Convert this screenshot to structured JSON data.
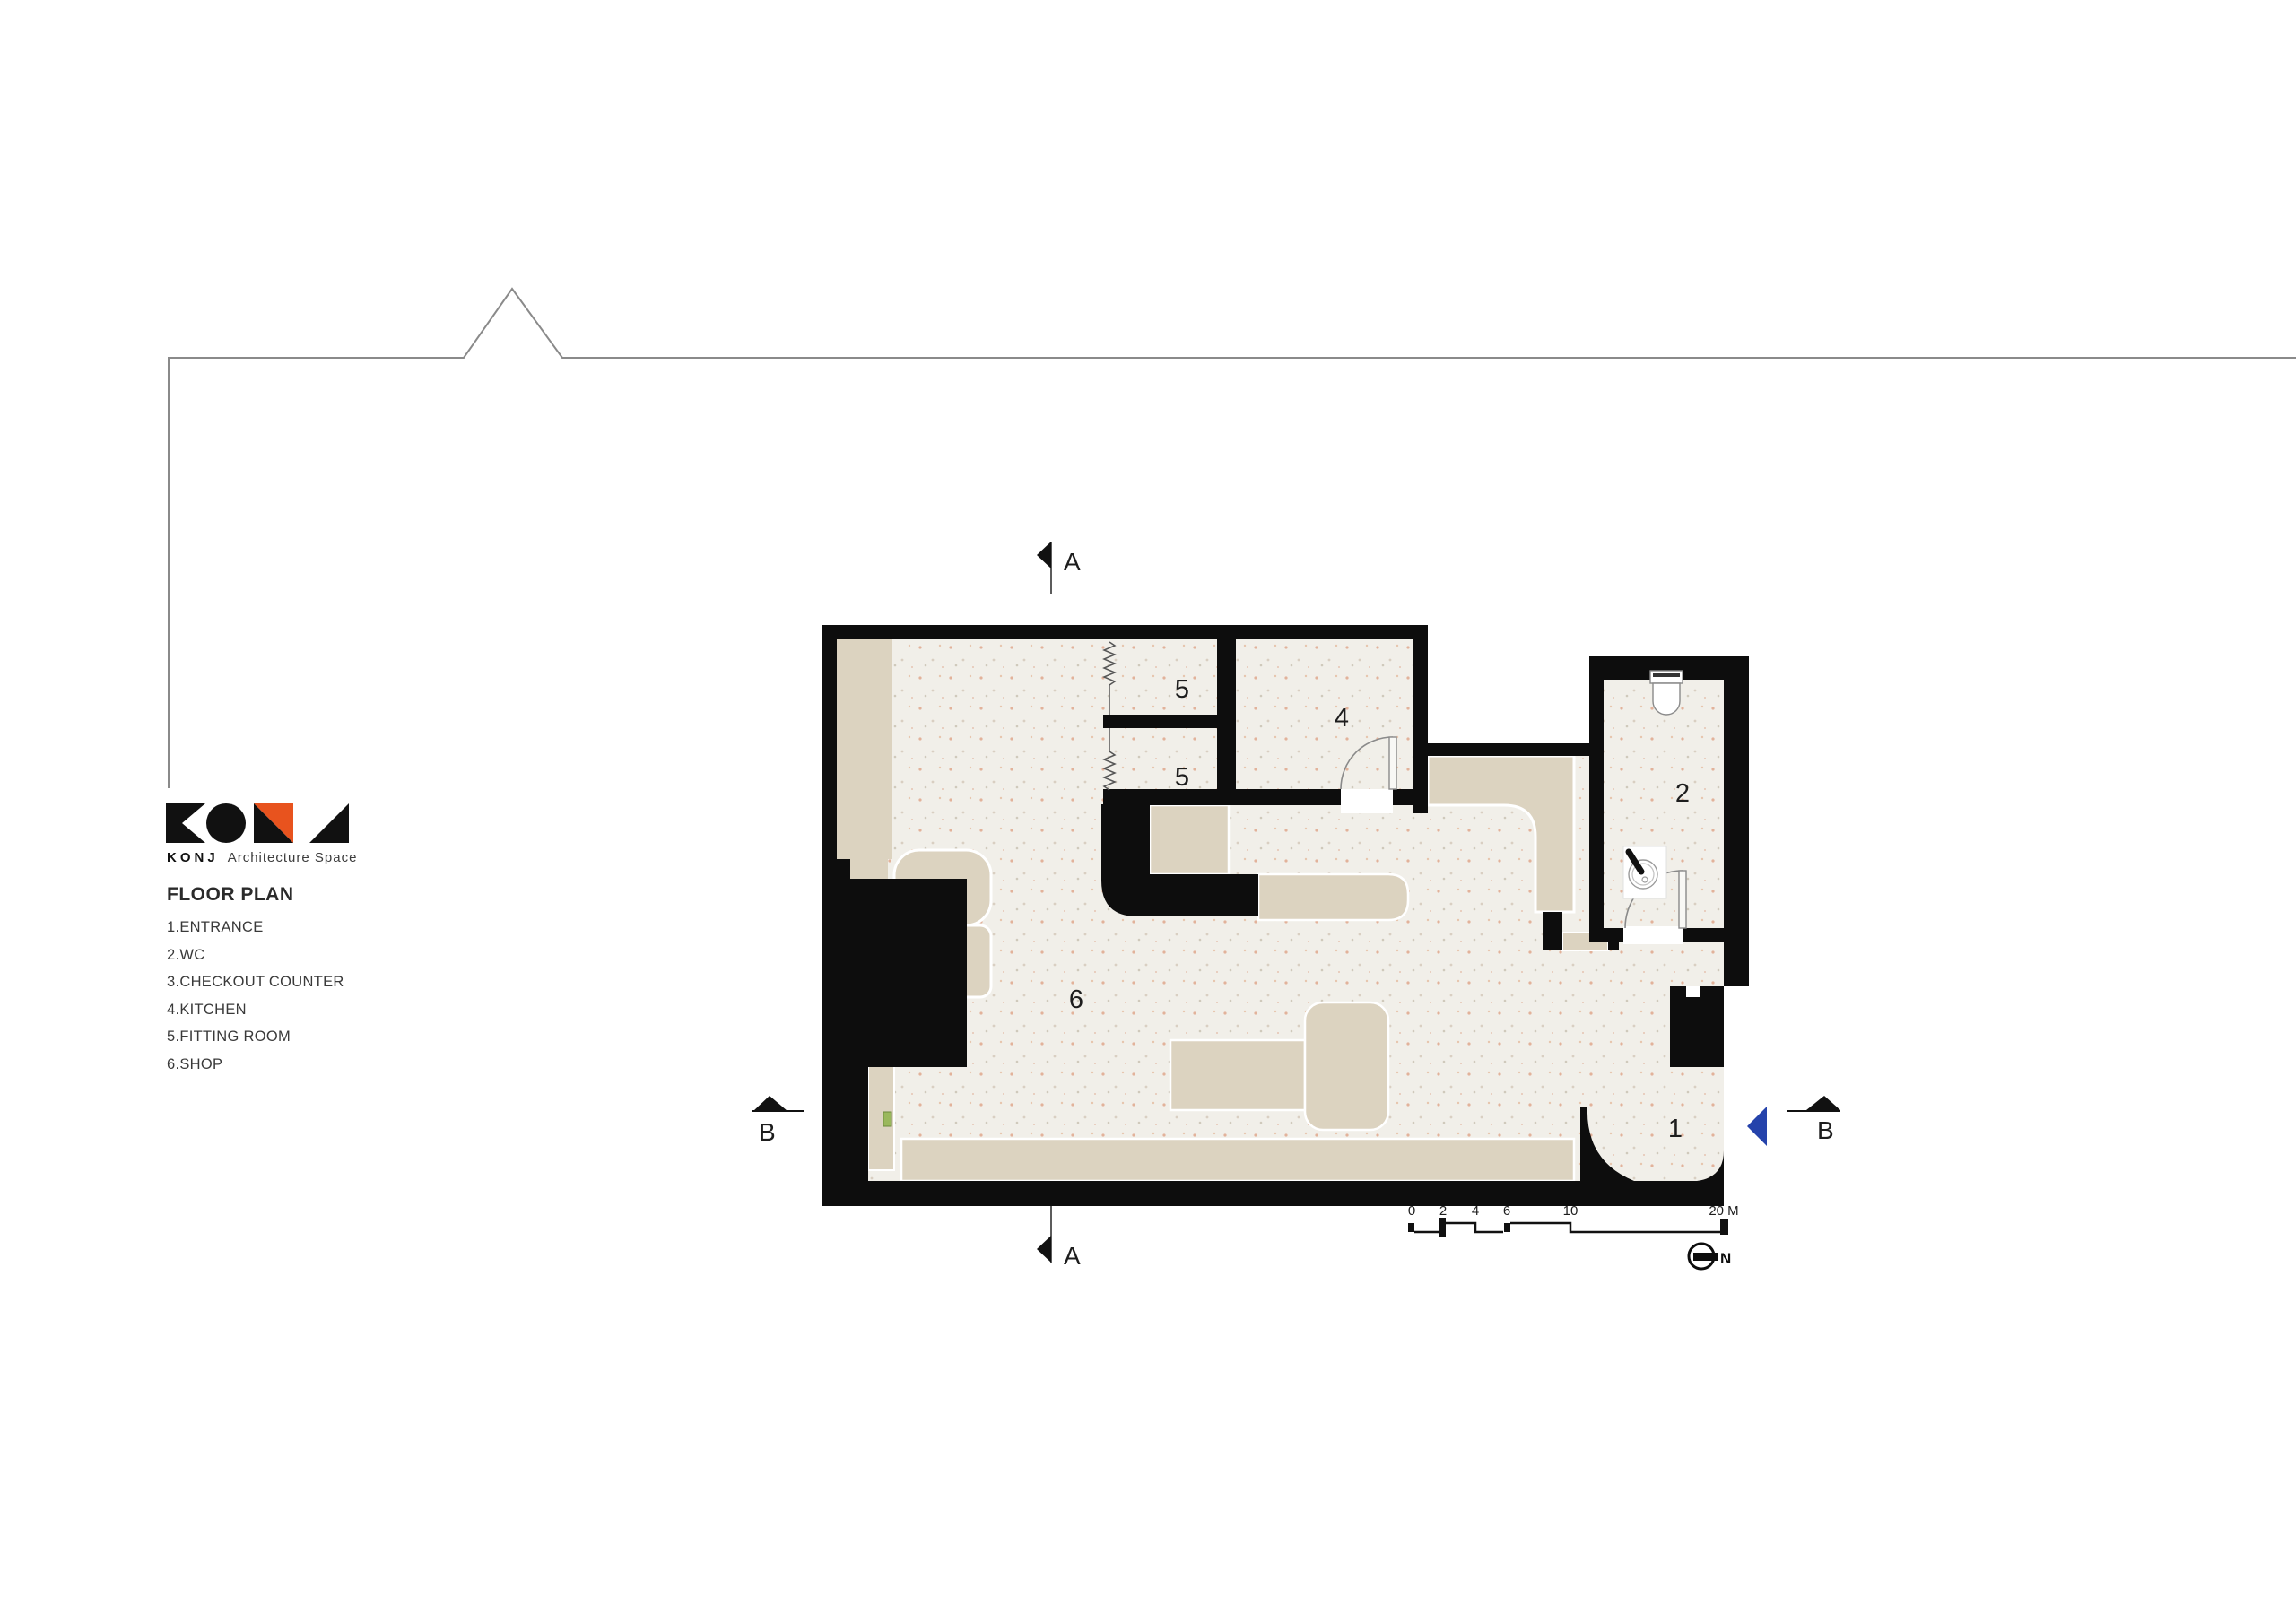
{
  "logo": {
    "brand": "KONJ",
    "tagline": "Architecture Space"
  },
  "legend": {
    "title": "FLOOR PLAN",
    "items": [
      "1.ENTRANCE",
      "2.WC",
      "3.CHECKOUT COUNTER",
      "4.KITCHEN",
      "5.FITTING ROOM",
      "6.SHOP"
    ]
  },
  "plan": {
    "room_labels": {
      "fitting_room_top": "5",
      "fitting_room_bottom": "5",
      "kitchen": "4",
      "wc": "2",
      "shop": "6",
      "entrance": "1"
    }
  },
  "section_markers": {
    "a_top": "A",
    "a_bottom": "A",
    "b_left": "B",
    "b_right": "B"
  },
  "scale_bar": {
    "labels": [
      "0",
      "2",
      "4",
      "6",
      "10",
      "20 M"
    ]
  },
  "north_label": "N",
  "colors": {
    "accent_orange": "#e8531e",
    "section_blue": "#2543ab",
    "wall": "#0d0d0d",
    "floor": "#f1efe9",
    "furniture": "#dcd3c0"
  }
}
